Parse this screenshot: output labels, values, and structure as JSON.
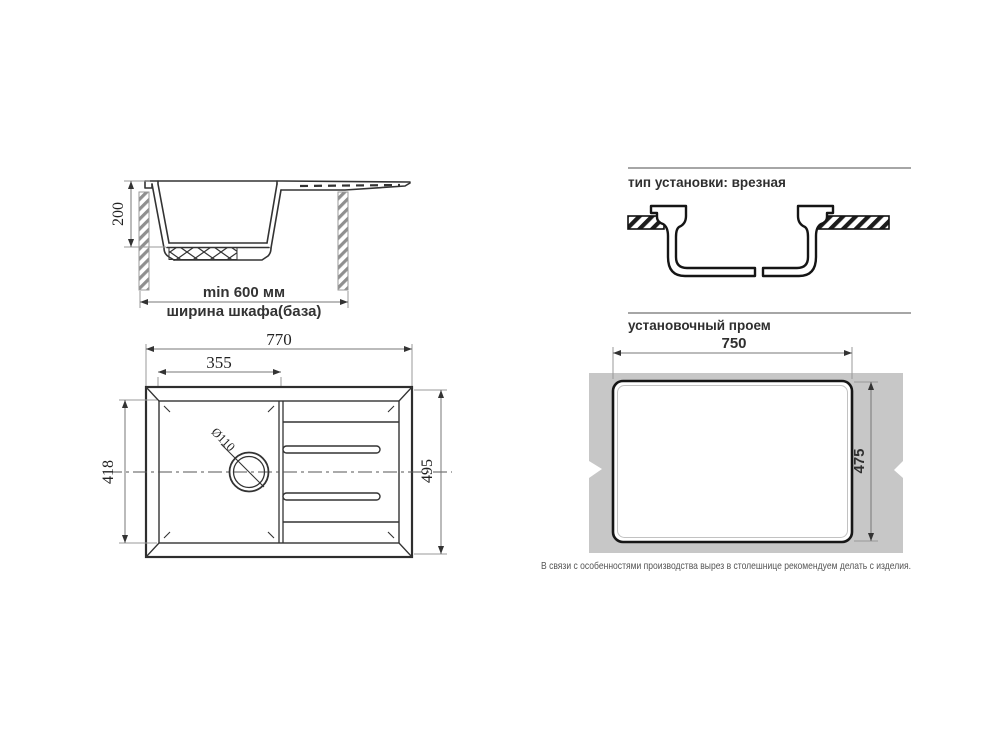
{
  "sections": {
    "cabinet": {
      "dim_depth": "200",
      "dim_min_width": "min 600 мм",
      "label": "ширина шкафа(база)"
    },
    "mount": {
      "heading": "тип установки: врезная"
    },
    "top_view": {
      "dim_overall_width": "770",
      "dim_bowl_width": "355",
      "dim_bowl_depth": "418",
      "dim_overall_depth": "495",
      "dim_drain": "Ø110"
    },
    "cutout": {
      "heading": "установочный проем",
      "dim_width": "750",
      "dim_height": "475",
      "note": "В связи с особенностями производства вырез в столешнице рекомендуем делать с изделия."
    }
  },
  "colors": {
    "line": "#333333",
    "dimension_line": "#777777",
    "countertop_fill": "#c7c7c7",
    "text": "#333333"
  }
}
